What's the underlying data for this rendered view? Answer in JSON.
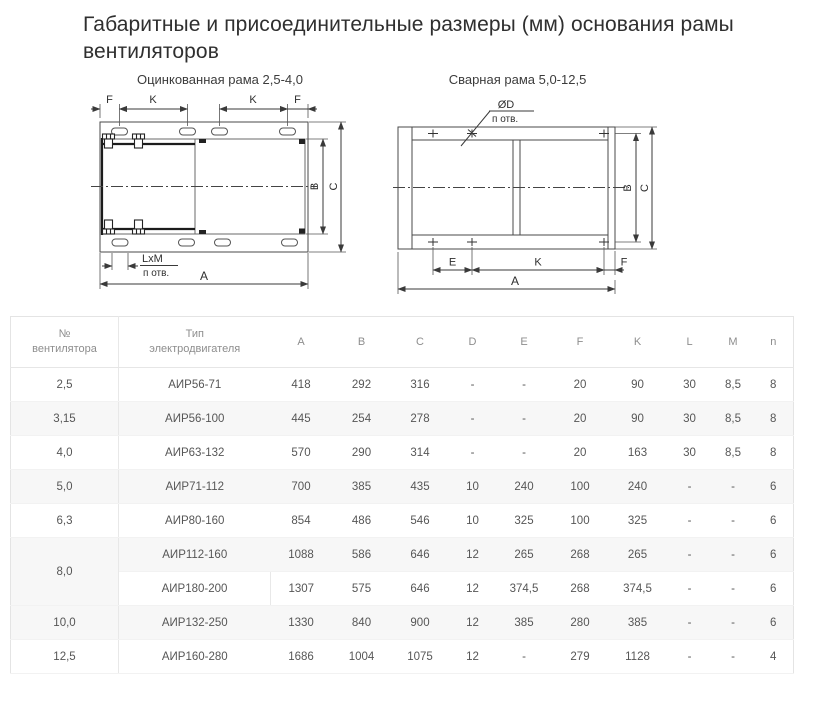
{
  "page": {
    "title_line1": "Габаритные и присоединительные размеры (мм) основания рамы",
    "title_line2": "вентиляторов"
  },
  "figures": {
    "left": {
      "title": "Оцинкованная рама 2,5-4,0",
      "dims": {
        "f1": "F",
        "k1": "K",
        "k2": "K",
        "f2": "F",
        "b": "B",
        "c": "C",
        "a": "A",
        "slot": "LxM",
        "holes": "п отв."
      }
    },
    "right": {
      "title": "Сварная рама 5,0-12,5",
      "dims": {
        "d": "ØD",
        "holes": "п отв.",
        "b": "B",
        "c": "C",
        "e": "E",
        "k": "K",
        "f": "F",
        "a": "A"
      }
    }
  },
  "table": {
    "col1_header_line1": "№",
    "col1_header_line2": "вентилятора",
    "col2_header_line1": "Тип",
    "col2_header_line2": "электродвигателя",
    "dim_headers": [
      "A",
      "B",
      "C",
      "D",
      "E",
      "F",
      "K",
      "L",
      "M",
      "n"
    ],
    "rows": [
      {
        "no": "2,5",
        "rowspan": 1,
        "shaded": false,
        "type": "АИР56-71",
        "values": [
          "418",
          "292",
          "316",
          "-",
          "-",
          "20",
          "90",
          "30",
          "8,5",
          "8"
        ]
      },
      {
        "no": "3,15",
        "rowspan": 1,
        "shaded": true,
        "type": "АИР56-100",
        "values": [
          "445",
          "254",
          "278",
          "-",
          "-",
          "20",
          "90",
          "30",
          "8,5",
          "8"
        ]
      },
      {
        "no": "4,0",
        "rowspan": 1,
        "shaded": false,
        "type": "АИР63-132",
        "values": [
          "570",
          "290",
          "314",
          "-",
          "-",
          "20",
          "163",
          "30",
          "8,5",
          "8"
        ]
      },
      {
        "no": "5,0",
        "rowspan": 1,
        "shaded": true,
        "type": "АИР71-112",
        "values": [
          "700",
          "385",
          "435",
          "10",
          "240",
          "100",
          "240",
          "-",
          "-",
          "6"
        ]
      },
      {
        "no": "6,3",
        "rowspan": 1,
        "shaded": false,
        "type": "АИР80-160",
        "values": [
          "854",
          "486",
          "546",
          "10",
          "325",
          "100",
          "325",
          "-",
          "-",
          "6"
        ]
      },
      {
        "no": "8,0",
        "rowspan": 2,
        "shaded": true,
        "type": "АИР112-160",
        "values": [
          "1088",
          "586",
          "646",
          "12",
          "265",
          "268",
          "265",
          "-",
          "-",
          "6"
        ]
      },
      {
        "no": null,
        "rowspan": 0,
        "shaded": false,
        "type_divider": true,
        "type": "АИР180-200",
        "values": [
          "1307",
          "575",
          "646",
          "12",
          "374,5",
          "268",
          "374,5",
          "-",
          "-",
          "6"
        ]
      },
      {
        "no": "10,0",
        "rowspan": 1,
        "shaded": true,
        "type": "АИР132-250",
        "values": [
          "1330",
          "840",
          "900",
          "12",
          "385",
          "280",
          "385",
          "-",
          "-",
          "6"
        ]
      },
      {
        "no": "12,5",
        "rowspan": 1,
        "shaded": false,
        "type": "АИР160-280",
        "values": [
          "1686",
          "1004",
          "1075",
          "12",
          "-",
          "279",
          "1128",
          "-",
          "-",
          "4"
        ]
      }
    ]
  }
}
